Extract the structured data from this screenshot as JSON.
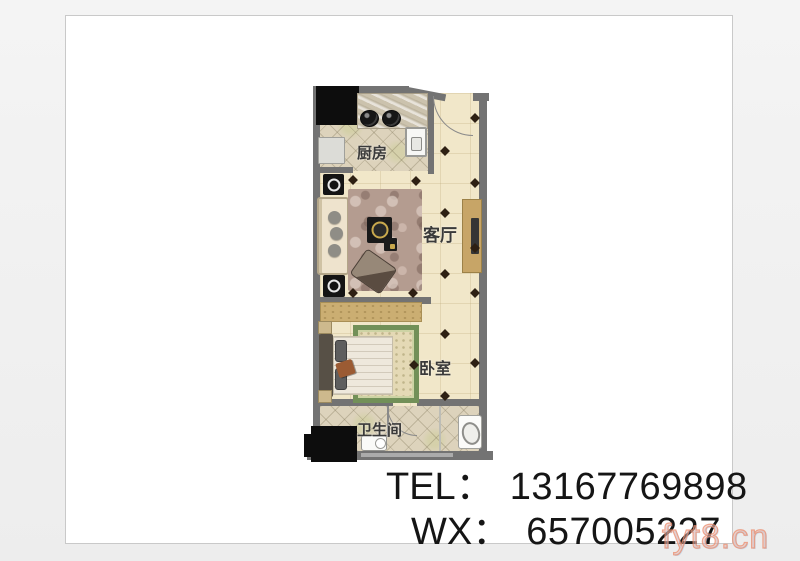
{
  "page": {
    "background": "#efefef",
    "card_background": "#ffffff"
  },
  "floorplan": {
    "kitchen_label": "厨房",
    "living_label": "客厅",
    "bedroom_label": "卧室",
    "bathroom_label": "卫生间"
  },
  "contact": {
    "tel_label": "TEL：",
    "tel_number": "13167769898",
    "wx_label": "WX：",
    "wx_number": "657005227"
  },
  "watermark": {
    "text": "fyt8.cn",
    "color": "#ef9d82"
  },
  "colors": {
    "wall": "#737373",
    "floor_cream": "#f1e7c9",
    "tile_beige": "#ddd3bc",
    "cabinet_tan": "#c9ad74",
    "bed_rug_green": "#729058",
    "contact_text": "#151515"
  }
}
